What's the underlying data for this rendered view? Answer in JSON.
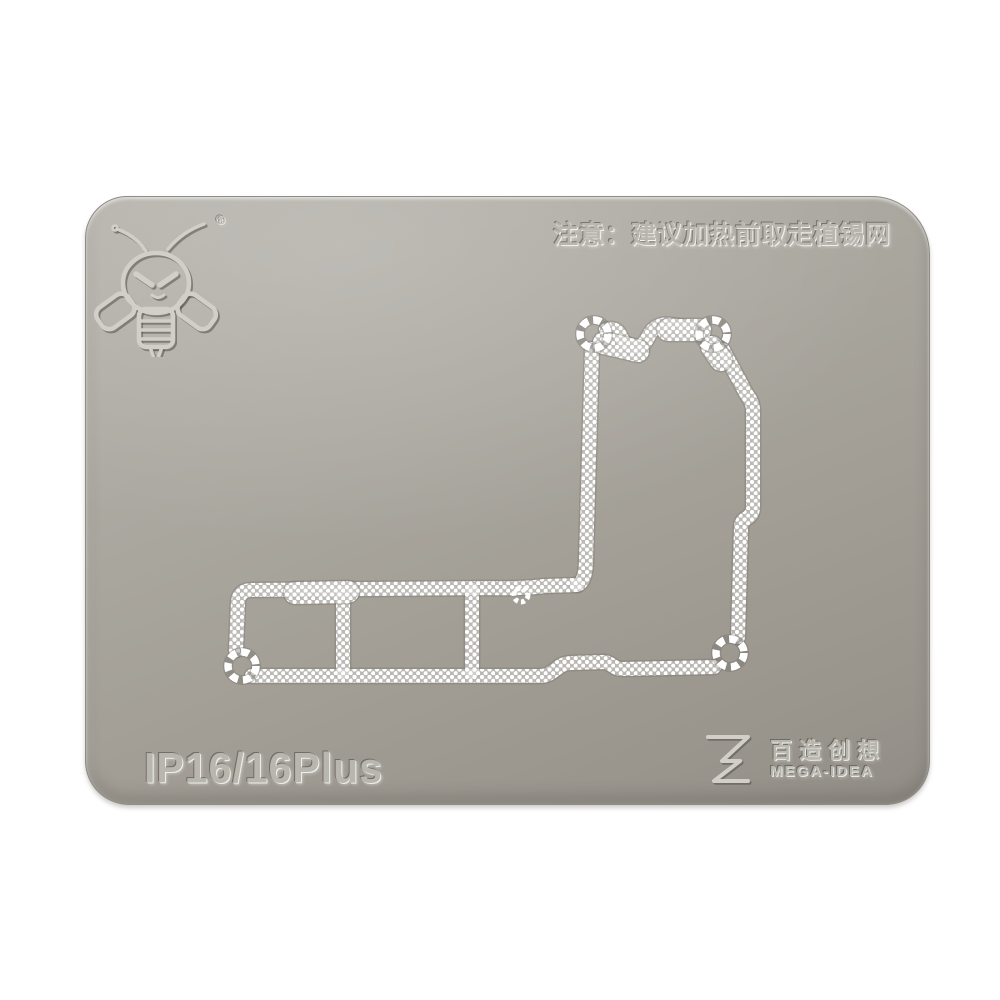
{
  "scene": {
    "type": "product-photo",
    "background_color": "#ffffff"
  },
  "plate": {
    "warning_text": "注意：建议加热前取走植锡网",
    "model_label": "IP16/16Plus",
    "registered_mark": "®",
    "brand": {
      "name_cn": "百造创想",
      "name_en": "MEGA-IDEA"
    },
    "stencil": {
      "screw_holes": 4,
      "mesh_color": "#ffffff"
    },
    "colors": {
      "plate_top": "#b4b1aa",
      "plate_mid": "#a29e96",
      "plate_bottom": "#918d86",
      "emboss_text": "#b9b6ae"
    }
  },
  "icons": {
    "bee": "bee-logo",
    "brand_mark": "hourglass-z-logo"
  }
}
